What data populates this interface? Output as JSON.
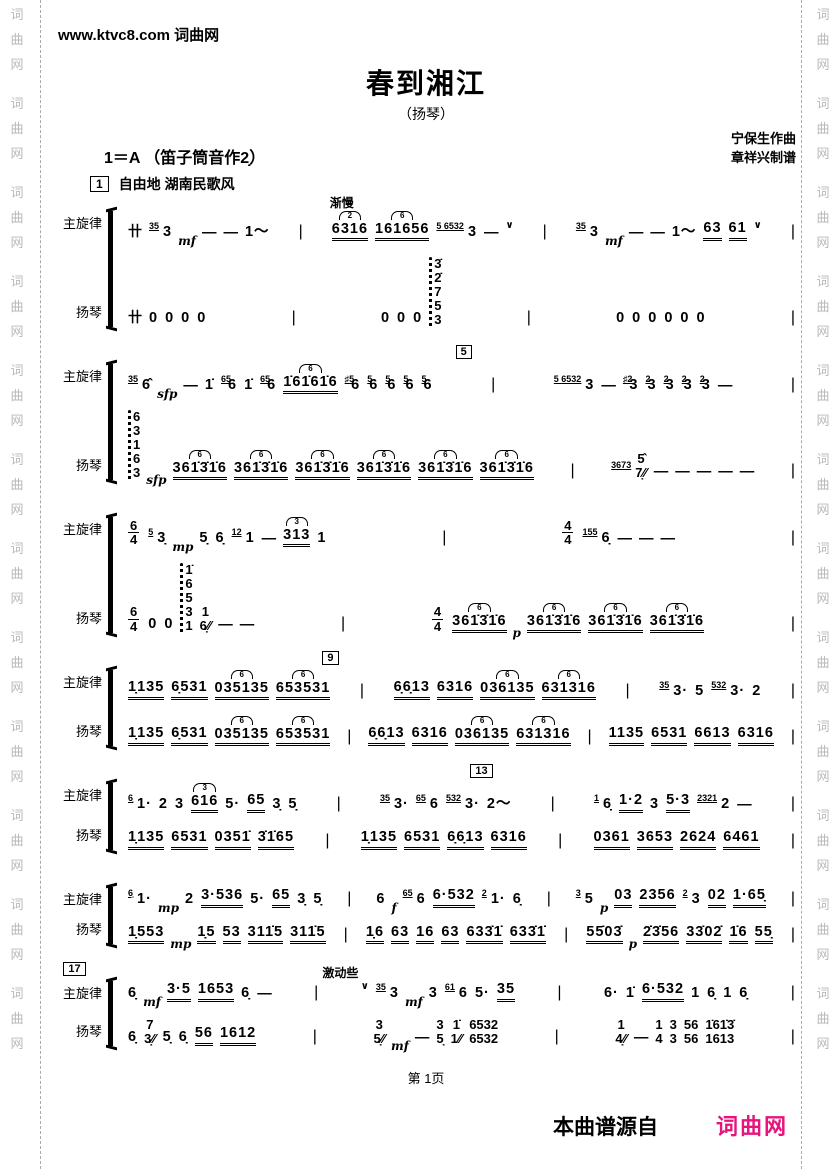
{
  "page": {
    "top_watermark": "www.ktvc8.com 词曲网",
    "side_watermark_chars": [
      "词",
      "曲",
      "网"
    ],
    "footer_page": "第 1页",
    "source_label": "本曲谱源自",
    "source_logo": "词曲网",
    "logo_color": "#e8137d"
  },
  "header": {
    "title": "春到湘江",
    "subtitle": "（扬琴）",
    "key_line": "1＝A （笛子筒音作2̣）",
    "composer": "宁保生作曲",
    "arranger": "章祥兴制谱",
    "rehearsal_mark": "1",
    "tempo_text": "自由地  湖南民歌风"
  },
  "part_labels": {
    "melody": "主旋律",
    "yangqin": "扬琴"
  },
  "systems": [
    {
      "annotations": [
        {
          "text": "渐慢",
          "left": "37%"
        }
      ],
      "melody": [
        "卄 (35) 3 $mf — — 1〜",
        "^2:6316 ^6:161656 (5 6532) 3 — ∨",
        "(35) 3 $mf — — 1〜 63 61 ∨"
      ],
      "yangqin": [
        "卄 0 0 0 0",
        "0 0 0 ~{3̇,2̇,7,5,3}",
        "0 0 0 0 0 0"
      ]
    },
    {
      "box": {
        "label": "5",
        "left": "54%"
      },
      "melody": [
        "(35) 6̂ $sfp — 1̇ (65)6 1̇ (65)6 ^6:1̇61̇61̇6 (♯5)6 (5)6 (5)6 (5)6 (5)6",
        "(5 6532) 3 — (♯2)3 (2)3 (2)3 (2)3 (2)3 —"
      ],
      "yangqin": [
        "~{6,3,1,6,3} $sfp ^6:361̇3̇1̇6 ^6:361̇3̇1̇6 ^6:361̇3̇1̇6 ^6:361̇3̇1̇6 ^6:361̇3̇1̇6 ^6:361̇3̇1̇6",
        "(3673) {5̂,7̣⁄⁄} — — — — —"
      ]
    },
    {
      "melody": [
        "§6/4 (5) 3̣ $mp 5̣ 6̣ (12) 1 — ^3:313 1",
        "§4/4 (155) 6̣ — — —"
      ],
      "yangqin": [
        "§6/4 0 0 ~{1̇,6,5,3,1} {1,6̣⁄⁄} — —",
        "§4/4 ^6:361̇3̇1̇6 $p ^6:361̇3̇1̇6 ^6:361̇3̇1̇6 ^6:361̇3̇1̇6"
      ]
    },
    {
      "box": {
        "label": "9",
        "left": "36%"
      },
      "melody": [
        "1̣135 6̣531 ^6:035135 ^6:653531",
        "6̣6̣13 6316 ^6:036135 ^6:631316",
        "(35) 3· 5 (532) 3· 2"
      ],
      "yangqin": [
        "1̣135 6̣531 ^6:035135 ^6:653531",
        "6̣6̣13 6316 ^6:036135 ^6:631316",
        "1135 6531 6613 6316"
      ]
    },
    {
      "box": {
        "label": "13",
        "left": "56%"
      },
      "melody": [
        "(6̣) 1· 2 3 ^3:616 5· 65 3̣ 5̣",
        "(35) 3· (65) 6 (532) 3· 2〜",
        "(1) 6̣ 1·2 3 5·3 (2321) 2 —"
      ],
      "yangqin": [
        "1̣135 6531 0351̇ 3̇1̇65",
        "1̣135 6531 6̣6̣13 6316",
        "0361 3653 2624 6461"
      ]
    },
    {
      "melody": [
        "(6̣) 1· $mp 2 3·536 5· 65 3̣ 5̣",
        "6 $f (65) 6 6·532 (2) 1· 6̣",
        "(3) 5 $p 03 2356 (2) 3 02 1·65̣"
      ],
      "yangqin": [
        "1̣553 $mp 1̣5 53 311̇5 311̇5",
        "1̣6 63 16 63 633̇1̇ 633̇1̇",
        "55̇03̇ $p 2̇3̇56 33̇02̇ 1̇6 55̣"
      ]
    },
    {
      "box": {
        "label": "17",
        "left": "1%"
      },
      "annotations": [
        {
          "text": "激动些",
          "left": "36%"
        }
      ],
      "melody": [
        "6̣ $mf 3·5 1653 6̣ —",
        "∨ (35) 3 $mf 3 (61) 6 5· 35",
        "6· 1̇ 6·532 1 6̣ 1 6̣"
      ],
      "yangqin": [
        "6̣ {7,3̣⁄⁄} 5̣ 6̣ 56 1612",
        "{3,5̣⁄⁄} $mf — {3,5̣} {1̇,1⁄⁄} {6532,6532}",
        "{1,4̣⁄⁄} — {1,4} {3,3} {56,56} {1̇61̇3̇,1613}"
      ]
    }
  ]
}
